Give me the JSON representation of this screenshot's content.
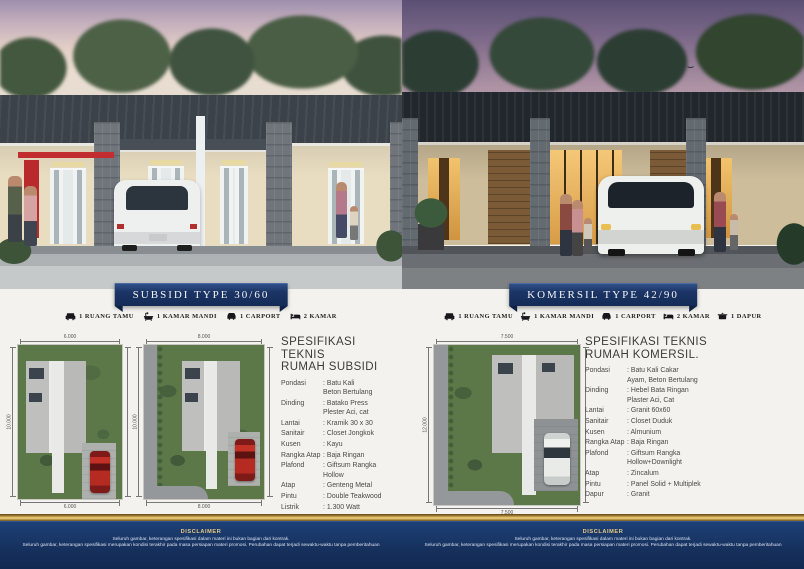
{
  "subsidi": {
    "banner": "SUBSIDI TYPE 30/60",
    "features": [
      {
        "icon": "sofa-icon",
        "label": "1 RUANG TAMU"
      },
      {
        "icon": "bathtub-icon",
        "label": "1 KAMAR MANDI"
      },
      {
        "icon": "car-icon",
        "label": "1 CARPORT"
      },
      {
        "icon": "bed-icon",
        "label": "2 KAMAR"
      }
    ],
    "spec_title": {
      "line1": "SPESIFIKASI TEKNIS",
      "line2": "RUMAH SUBSIDI"
    },
    "specs": [
      {
        "label": "Pondasi",
        "value": "Batu Kali\nBeton Bertulang"
      },
      {
        "label": "Dinding",
        "value": "Batako Press\nPlester Aci, cat"
      },
      {
        "label": "Lantai",
        "value": "Kramik 30 x 30"
      },
      {
        "label": "Sanitair",
        "value": "Closet Jongkok"
      },
      {
        "label": "Kusen",
        "value": "Kayu"
      },
      {
        "label": "Rangka Atap",
        "value": "Baja Ringan"
      },
      {
        "label": "Plafond",
        "value": "Giftsum Rangka\nHollow"
      },
      {
        "label": "Atap",
        "value": "Genteng Metal"
      },
      {
        "label": "Pintu",
        "value": "Double Teakwood"
      },
      {
        "label": "Listrik",
        "value": "1.300 Watt"
      }
    ],
    "plans": [
      {
        "top_dim": "6.000",
        "bottom_dim": "6.000",
        "side_dim": "10.000"
      },
      {
        "top_dim": "8.000",
        "bottom_dim": "8.000",
        "side_dim": "10.000"
      }
    ]
  },
  "komersil": {
    "banner": "KOMERSIL TYPE 42/90",
    "features": [
      {
        "icon": "sofa-icon",
        "label": "1 RUANG TAMU"
      },
      {
        "icon": "bathtub-icon",
        "label": "1 KAMAR MANDI"
      },
      {
        "icon": "car-icon",
        "label": "1 CARPORT"
      },
      {
        "icon": "bed-icon",
        "label": "2 KAMAR"
      },
      {
        "icon": "stove-icon",
        "label": "1 DAPUR"
      }
    ],
    "spec_title": {
      "line1": "SPESIFIKASI TEKNIS",
      "line2": "RUMAH KOMERSIL."
    },
    "specs": [
      {
        "label": "Pondasi",
        "value": "Batu Kali Cakar\nAyam, Beton Bertulang"
      },
      {
        "label": "Dinding",
        "value": "Hebel Bata Ringan\nPlaster Aci, Cat"
      },
      {
        "label": "Lantai",
        "value": "Granit 60x60"
      },
      {
        "label": "Sanitair",
        "value": "Closet Duduk"
      },
      {
        "label": "Kusen",
        "value": "Almunium"
      },
      {
        "label": "Rangka Atap",
        "value": "Baja Ringan"
      },
      {
        "label": "Plafond",
        "value": "Giftsum Rangka\nHollow+Downlight"
      },
      {
        "label": "Atap",
        "value": "Zincalum"
      },
      {
        "label": "Pintu",
        "value": "Panel Solid + Multiplek"
      },
      {
        "label": "Dapur",
        "value": "Granit"
      }
    ],
    "plan": {
      "top_dim": "7.500",
      "bottom_dim": "7.500",
      "side_dim": "12.000"
    }
  },
  "footer": {
    "disclaimer": {
      "title": "DISCLAIMER",
      "line1": "Seluruh gambar, keterangan spesifikasi dalam materi ini bukan bagian dari kontrak.",
      "line2": "Seluruh gambar, keterangan spesifikasi merupakan kondisi terakhir pada masa persiapan materi promosi. Perubahan dapat terjadi sewaktu-waktu tanpa pemberitahuan"
    }
  },
  "colors": {
    "banner_navy": "#1c3566",
    "footer_navy": "#16305c",
    "gold": "#d4ad58",
    "accent_red": "#c22d2f"
  }
}
